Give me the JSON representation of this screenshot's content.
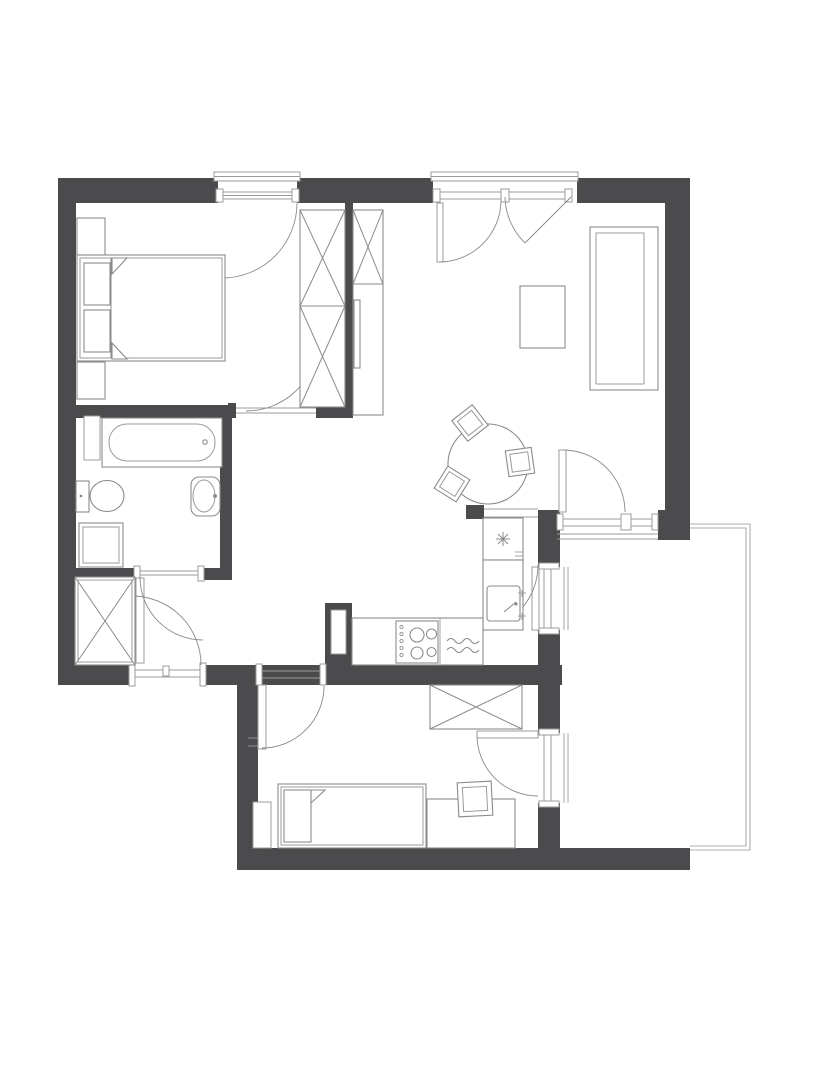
{
  "page": {
    "width": 818,
    "height": 1080,
    "background": "#ffffff"
  },
  "colors": {
    "wall": "#4b4b4d",
    "furniture_line": "#8b8b8b",
    "frame_line": "#9b9b9b",
    "railing_line": "#acacac",
    "floor": "#ffffff"
  },
  "floor_plan": {
    "kind": "apartment-floor-plan",
    "style": "monochrome architectural top-down drawing, no text labels",
    "rooms": [
      {
        "name": "bedroom",
        "position": "top-left",
        "items": [
          "double-bed",
          "pillow",
          "pillow",
          "nightstand",
          "nightstand",
          "built-in-wardrobe-crossed"
        ],
        "openings": [
          "french-window-with-swing",
          "interior-door"
        ]
      },
      {
        "name": "living-room",
        "position": "top-right",
        "items": [
          "sofa",
          "coffee-table",
          "tall-cabinet-crossed",
          "wall-panel",
          "round-dining-table",
          "dining-chair",
          "dining-chair",
          "dining-chair"
        ],
        "openings": [
          "double-french-window",
          "balcony-door-with-side-window"
        ]
      },
      {
        "name": "kitchen",
        "position": "center",
        "items": [
          "fridge-freezer-snowflake",
          "sink-unit",
          "worktop",
          "hob-four-burner",
          "dishwasher-waves"
        ],
        "openings": [
          "balcony-facing-window-door"
        ]
      },
      {
        "name": "bathroom",
        "position": "middle-left",
        "items": [
          "bathtub",
          "toilet",
          "washbasin",
          "washing-machine",
          "wall-niche"
        ],
        "openings": [
          "interior-door"
        ]
      },
      {
        "name": "hallway",
        "position": "bottom-left",
        "items": [
          "built-in-wardrobe-crossed"
        ],
        "openings": [
          "entrance-door",
          "passage-to-corridor"
        ]
      },
      {
        "name": "second-bedroom",
        "position": "bottom-center",
        "items": [
          "single-bed",
          "pillow",
          "desk",
          "desk-chair",
          "wardrobe-crossed",
          "wall-recess"
        ],
        "openings": [
          "interior-door",
          "balcony-window-door"
        ]
      },
      {
        "name": "balcony",
        "position": "right",
        "items": [
          "open-railing"
        ],
        "openings": []
      }
    ],
    "symbols": {
      "walls": "solid dark grey fill",
      "doors": "quarter-circle swing arcs with leaf",
      "wardrobes": "rectangles with diagonal cross",
      "windows": "double-line frames with end caps"
    }
  }
}
